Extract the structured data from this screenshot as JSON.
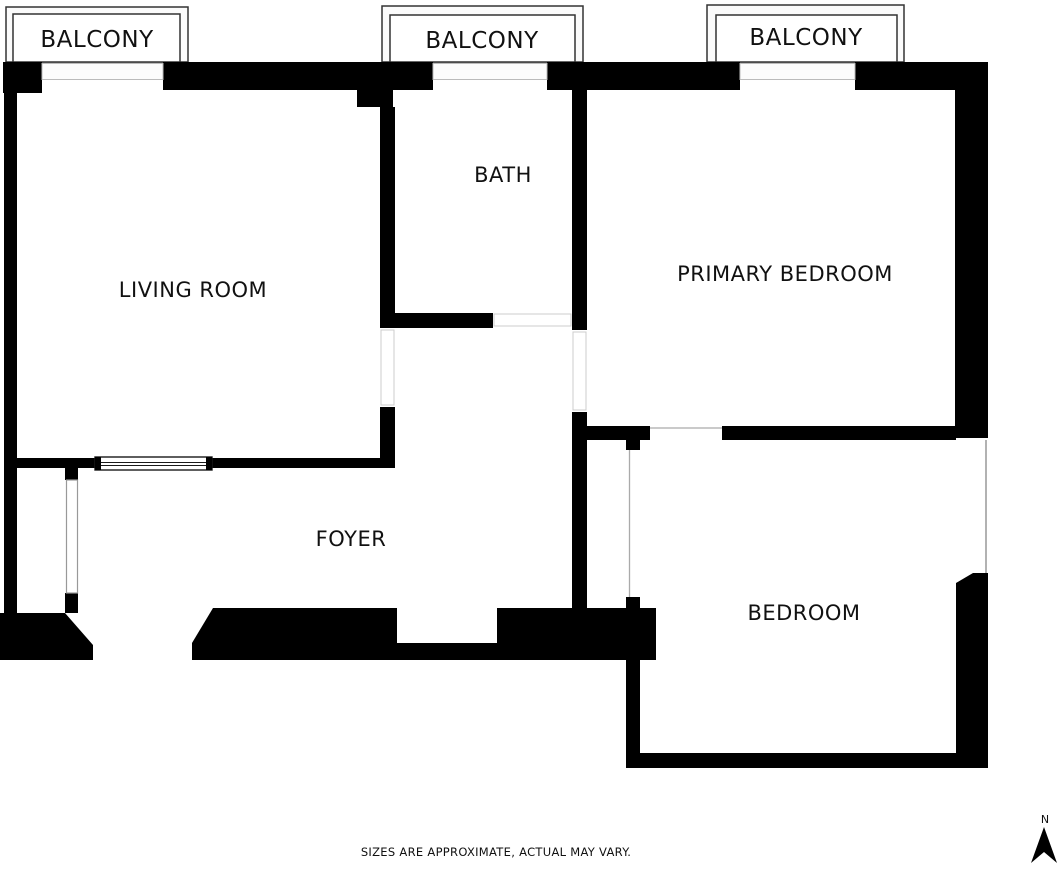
{
  "floor_plan": {
    "labels": {
      "balcony": "BALCONY",
      "living_room": "LIVING ROOM",
      "bath": "BATH",
      "primary_bedroom": "PRIMARY BEDROOM",
      "foyer": "FOYER",
      "bedroom": "BEDROOM"
    },
    "compass": {
      "north": "N"
    },
    "disclaimer": "SIZES ARE APPROXIMATE, ACTUAL MAY VARY.",
    "colors": {
      "wall": "#000000",
      "background": "#ffffff",
      "balcony_outline": "#333333",
      "balcony_fill": "#fbfbfb",
      "window_line": "#999999",
      "door_line": "#cccccc",
      "text": "#111111"
    }
  }
}
